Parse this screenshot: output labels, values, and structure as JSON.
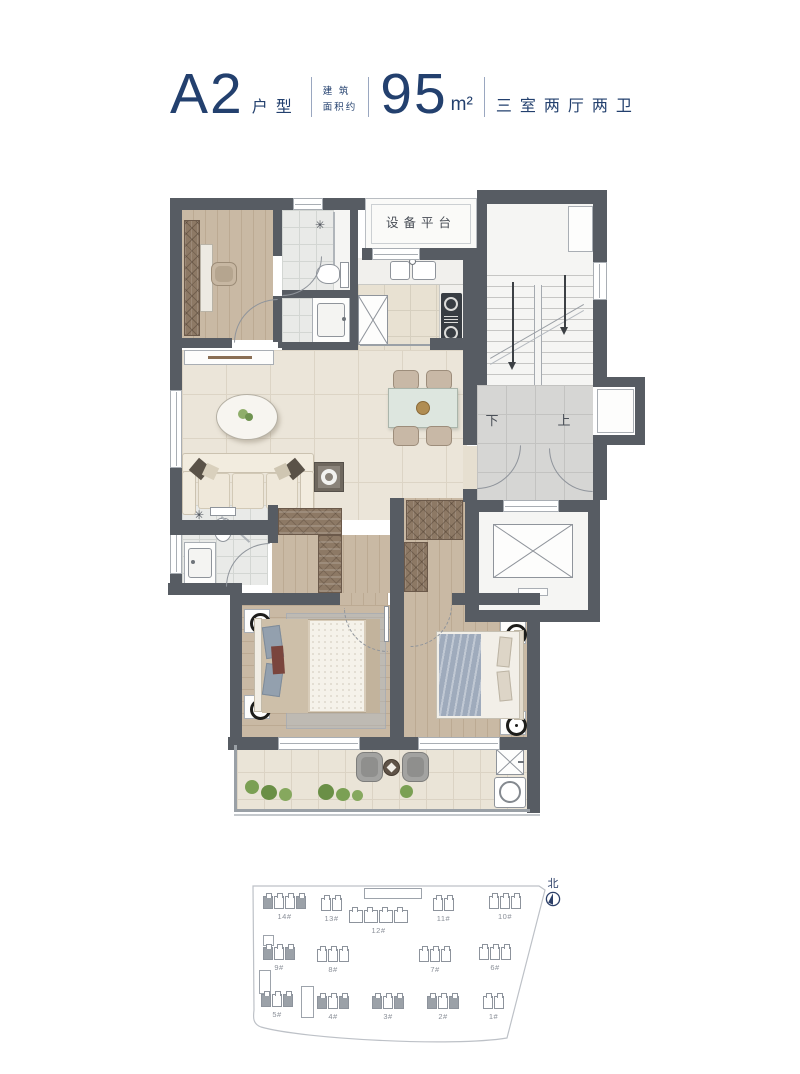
{
  "header": {
    "unit_name": "A2",
    "unit_type_label": "户型",
    "area_qualifier": "建 筑\n面积约",
    "area_value": "95",
    "area_unit": "m²",
    "layout_description": "三室两厅两卫",
    "text_color": "#23406e"
  },
  "floor_plan": {
    "labels": {
      "equipment_platform": "设备平台",
      "stair_down": "下",
      "stair_up": "上",
      "shower_symbol": "✳"
    },
    "colors": {
      "wall": "#575c63",
      "wood_floor": "#c9b9a4",
      "living_tile": "#ebe5d9",
      "bath_tile": "#e9eae8",
      "landing_tile": "#d6d6d4",
      "wardrobe_brown": "#8d7965",
      "plant_green": "#7ba054",
      "bed_blanket_blue": "#9fabbc"
    }
  },
  "site_plan": {
    "north_label": "北",
    "buildings": [
      {
        "label": "14#",
        "highlighted": true
      },
      {
        "label": "13#",
        "highlighted": false
      },
      {
        "label": "12#",
        "highlighted": false
      },
      {
        "label": "11#",
        "highlighted": false
      },
      {
        "label": "10#",
        "highlighted": false
      },
      {
        "label": "9#",
        "highlighted": true
      },
      {
        "label": "8#",
        "highlighted": false
      },
      {
        "label": "7#",
        "highlighted": false
      },
      {
        "label": "6#",
        "highlighted": false
      },
      {
        "label": "5#",
        "highlighted": true
      },
      {
        "label": "4#",
        "highlighted": true
      },
      {
        "label": "3#",
        "highlighted": true
      },
      {
        "label": "2#",
        "highlighted": true
      },
      {
        "label": "1#",
        "highlighted": false
      }
    ]
  }
}
